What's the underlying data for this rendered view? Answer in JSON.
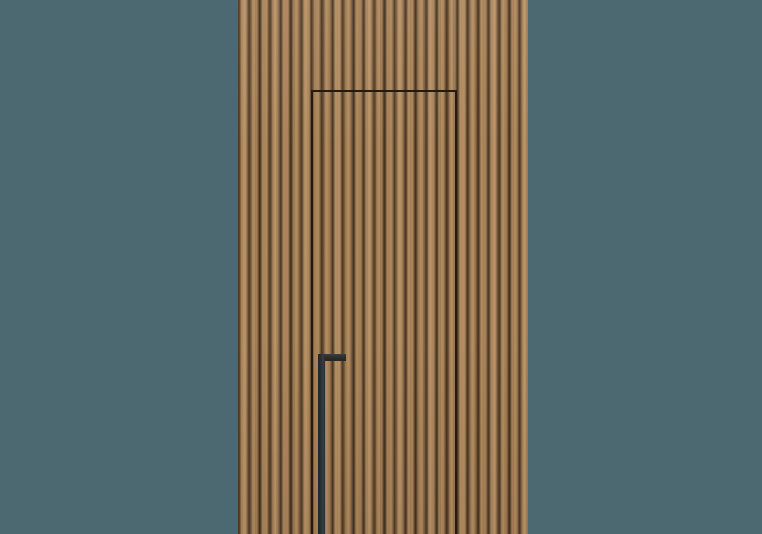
{
  "image": {
    "type": "product-render",
    "subject": "Concealed flush door integrated into a vertical wood slat wall panel, with a recessed black L-shaped pull handle, on a plain slate-teal studio background"
  },
  "colors": {
    "background": "#4c6871",
    "wood-face": "#ab8459",
    "wood-face-light": "#b78f63",
    "wood-groove": "#3e2e1c",
    "door-seam": "#241a0e",
    "handle": "#2c2f31",
    "handle-highlight": "#3a3e40"
  }
}
